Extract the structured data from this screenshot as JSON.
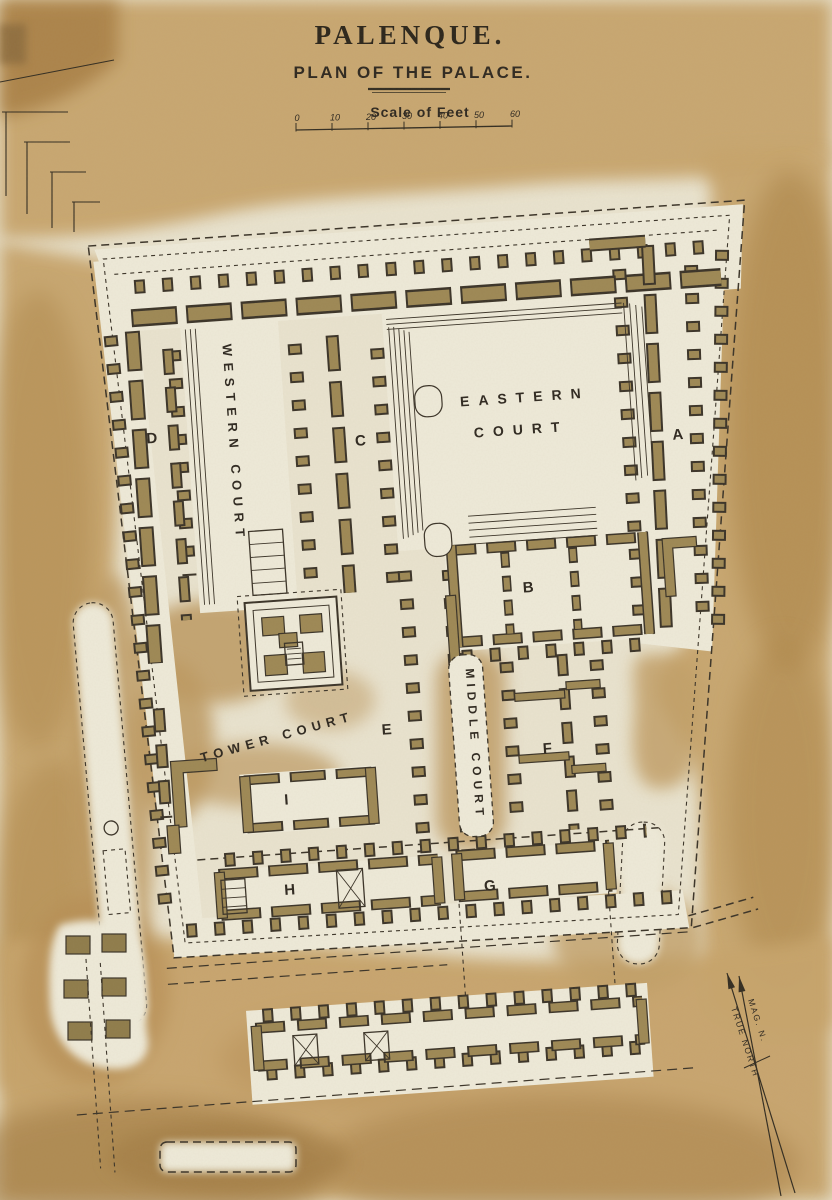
{
  "title": "PALENQUE.",
  "subtitle": "PLAN OF THE PALACE.",
  "scale": {
    "label": "Scale of Feet",
    "ticks": [
      "0",
      "10",
      "20",
      "30",
      "40",
      "50",
      "60"
    ]
  },
  "courts": {
    "western": "WESTERN COURT",
    "eastern_line1": "EASTERN",
    "eastern_line2": "COURT",
    "middle": "MIDDLE COURT",
    "tower": "TOWER COURT"
  },
  "letters": [
    "A",
    "B",
    "C",
    "D",
    "E",
    "F",
    "G",
    "H",
    "I"
  ],
  "compass": {
    "mag": "MAG. N.",
    "true": "TRUE NORTH"
  },
  "colors": {
    "paper": "#e9e3cf",
    "wash": "#c7a46c",
    "wall": "#9d8855",
    "ink": "#322c21"
  }
}
